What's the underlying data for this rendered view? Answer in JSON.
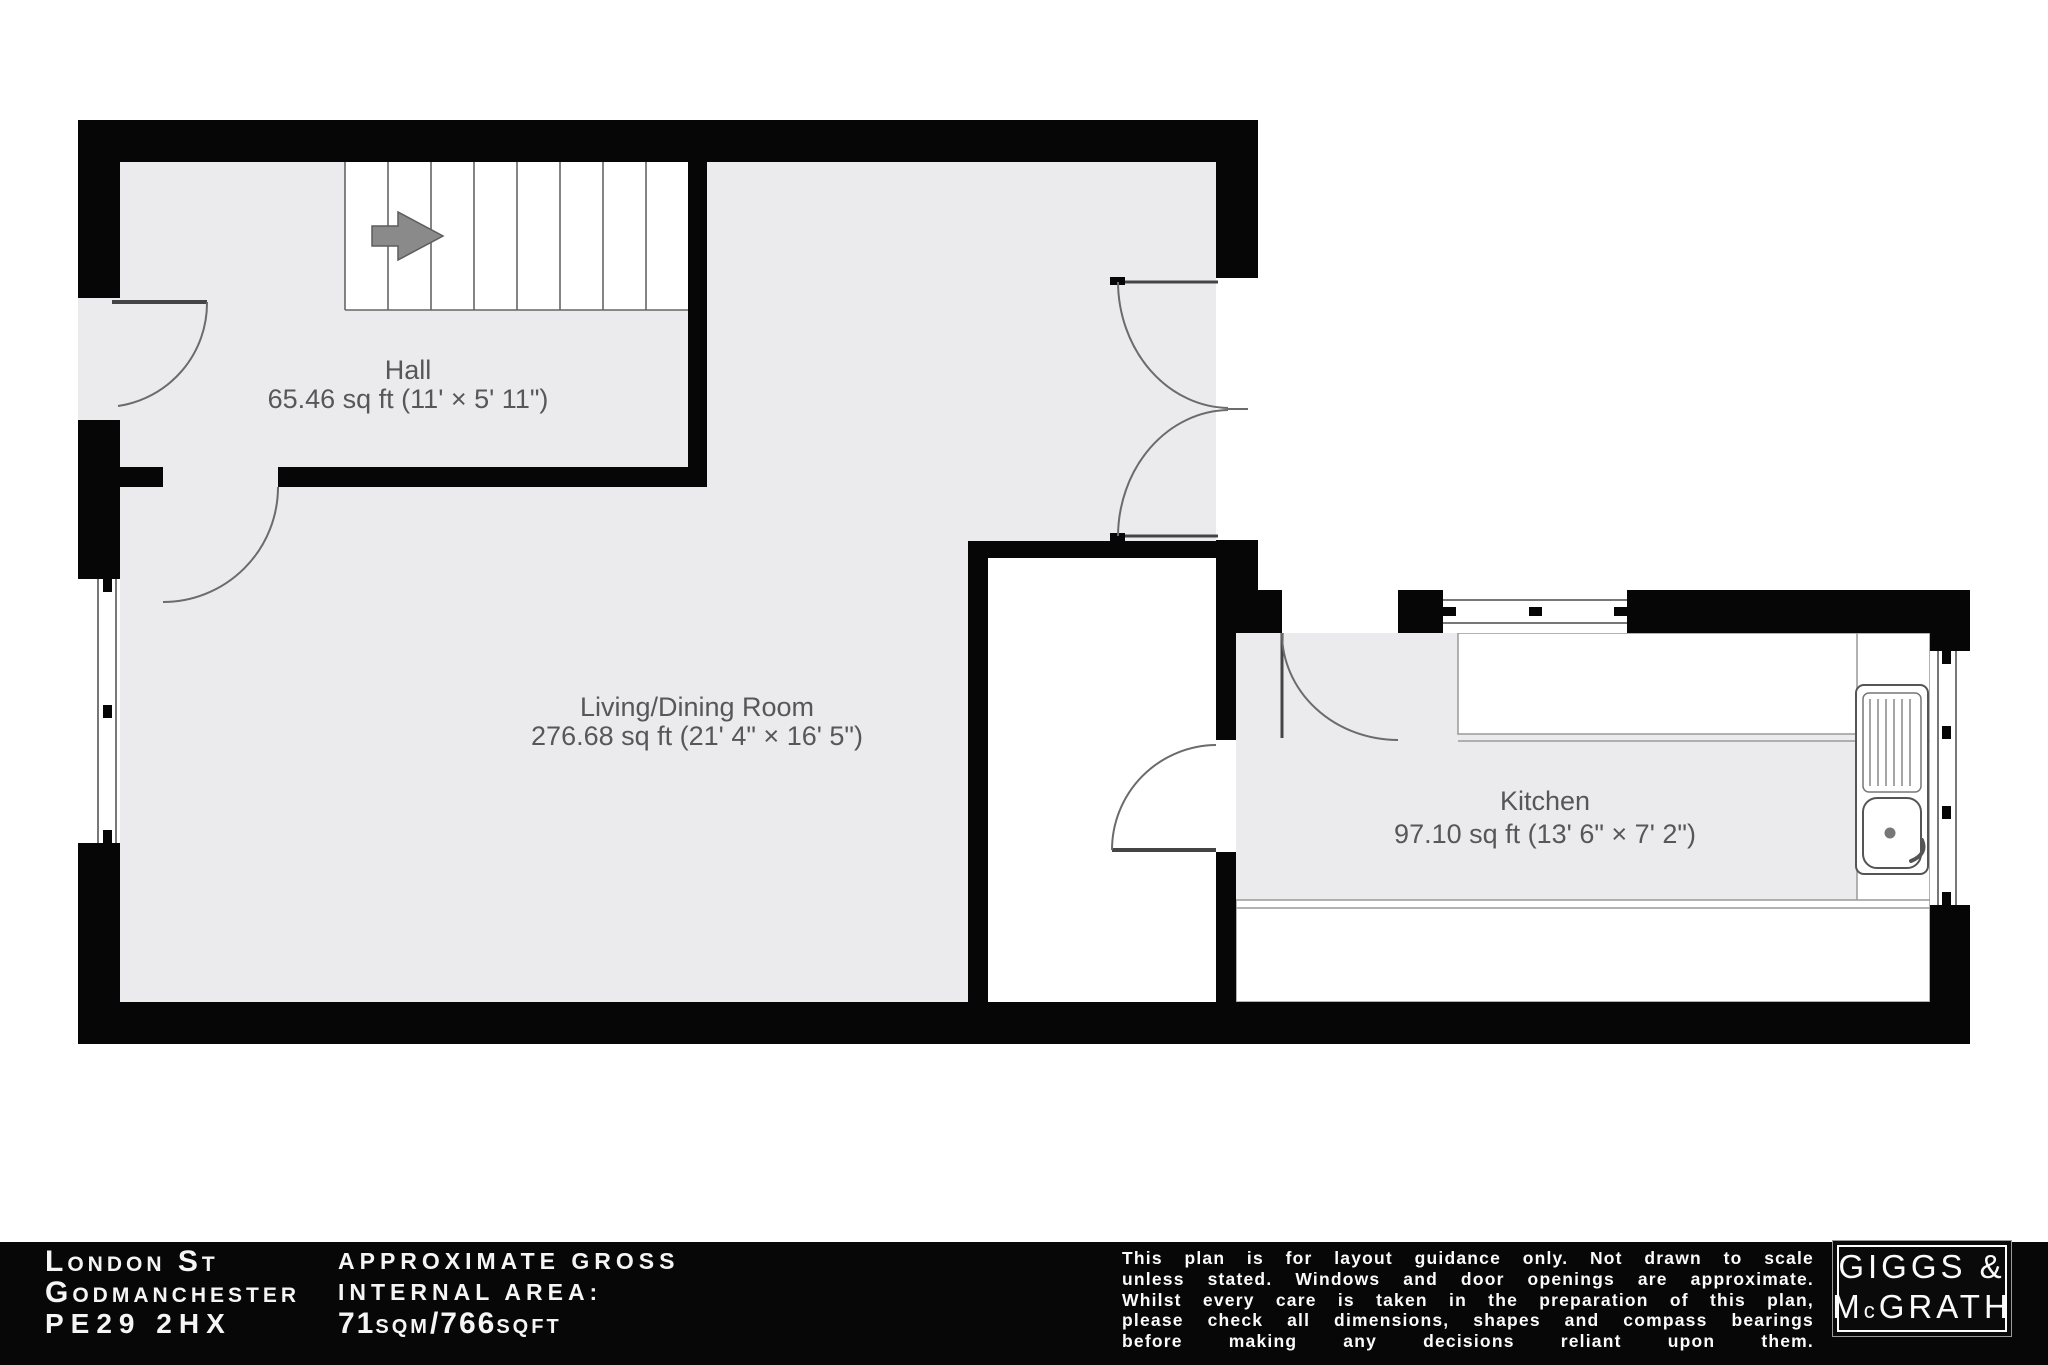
{
  "plan": {
    "rooms": [
      {
        "id": "hall",
        "name": "Hall",
        "area": "65.46 sq ft (11' × 5' 11\")"
      },
      {
        "id": "living",
        "name": "Living/Dining Room",
        "area": "276.68 sq ft (21' 4\" × 16' 5\")"
      },
      {
        "id": "kitchen",
        "name": "Kitchen",
        "area": "97.10 sq ft (13' 6\" × 7' 2\")"
      }
    ],
    "features": [
      "stairs-up-arrow",
      "entrance-door",
      "double-french-doors",
      "kitchen-door",
      "rear-door",
      "kitchen-sink",
      "windows"
    ]
  },
  "footer": {
    "address": {
      "line1": "London St",
      "line2": "Godmanchester",
      "line3": "PE29 2HX"
    },
    "area": {
      "caption1": "APPROXIMATE GROSS",
      "caption2": "INTERNAL AREA:",
      "v1": "71",
      "v2": "SQM",
      "v3": "/766",
      "v4": "SQFT"
    },
    "disclaimer_lines": [
      "This plan is for layout guidance only. Not drawn to scale",
      "unless stated. Windows and door openings are approximate.",
      "Whilst every care is taken in the preparation of this plan,",
      "please check all dimensions, shapes and compass bearings",
      "before making any decisions reliant upon them."
    ],
    "logo": {
      "word1": "GIGGS &",
      "m": "M",
      "c": "c",
      "rest": "GRATH"
    }
  },
  "colors": {
    "wall": "#060606",
    "floor": "#ebebed",
    "line": "#666666",
    "label": "#575757",
    "footer_bg": "#070707",
    "footer_text": "#f5f5f5"
  }
}
